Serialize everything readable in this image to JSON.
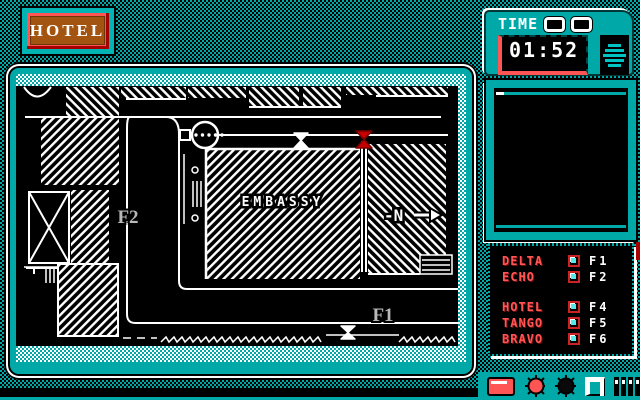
{
  "sign": {
    "text": "HOTEL"
  },
  "clock": {
    "label": "TIME",
    "value": "01:52"
  },
  "map": {
    "building_label": "EMBASSY",
    "compass_label": "-N",
    "zone_f1": "F1",
    "zone_f2": "F2"
  },
  "roster": {
    "teams": [
      {
        "name": "DELTA",
        "fkey": "F1"
      },
      {
        "name": "ECHO",
        "fkey": "F2"
      },
      {
        "name": "HOTEL",
        "fkey": "F4"
      },
      {
        "name": "TANGO",
        "fkey": "F5"
      },
      {
        "name": "BRAVO",
        "fkey": "F6"
      }
    ]
  },
  "colors": {
    "teal": "#00A8A8",
    "salmon": "#FF5555",
    "dark_red": "#A80000",
    "brown": "#A35410",
    "gray_label": "#B8B8B8",
    "bright_cyan": "#55E8E8"
  }
}
